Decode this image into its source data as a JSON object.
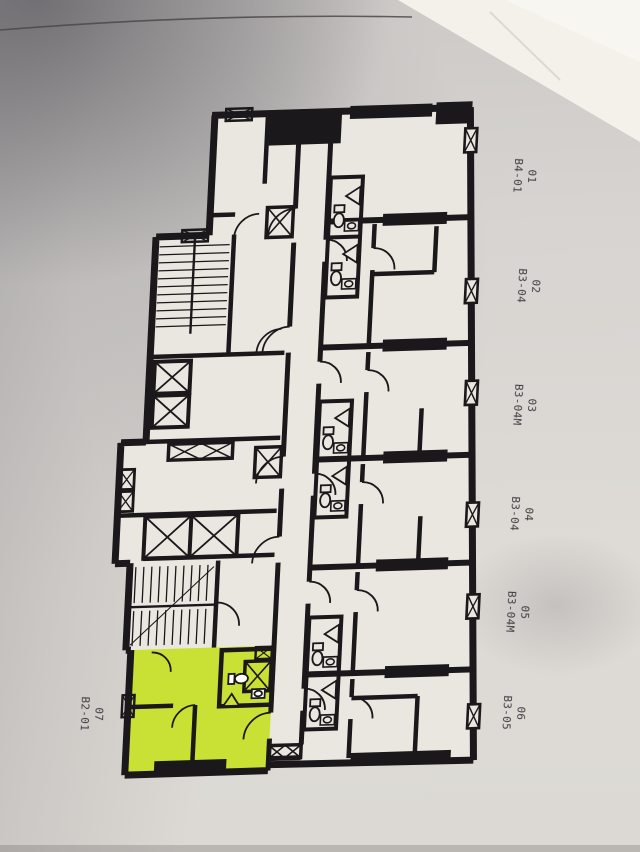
{
  "colors": {
    "highlight": "#c9e135",
    "walls": "#1a181b",
    "paper": "#eae7e0",
    "photo_background": "#d6d3d0",
    "label_text": "#3e3e42"
  },
  "units": [
    {
      "number": "01",
      "type": "B4-01",
      "highlighted": false
    },
    {
      "number": "02",
      "type": "B3-04",
      "highlighted": false
    },
    {
      "number": "03",
      "type": "B3-04M",
      "highlighted": false
    },
    {
      "number": "04",
      "type": "B3-04",
      "highlighted": false
    },
    {
      "number": "05",
      "type": "B3-04M",
      "highlighted": false
    },
    {
      "number": "06",
      "type": "B3-05",
      "highlighted": false
    },
    {
      "number": "07",
      "type": "B2-01",
      "highlighted": true
    }
  ]
}
